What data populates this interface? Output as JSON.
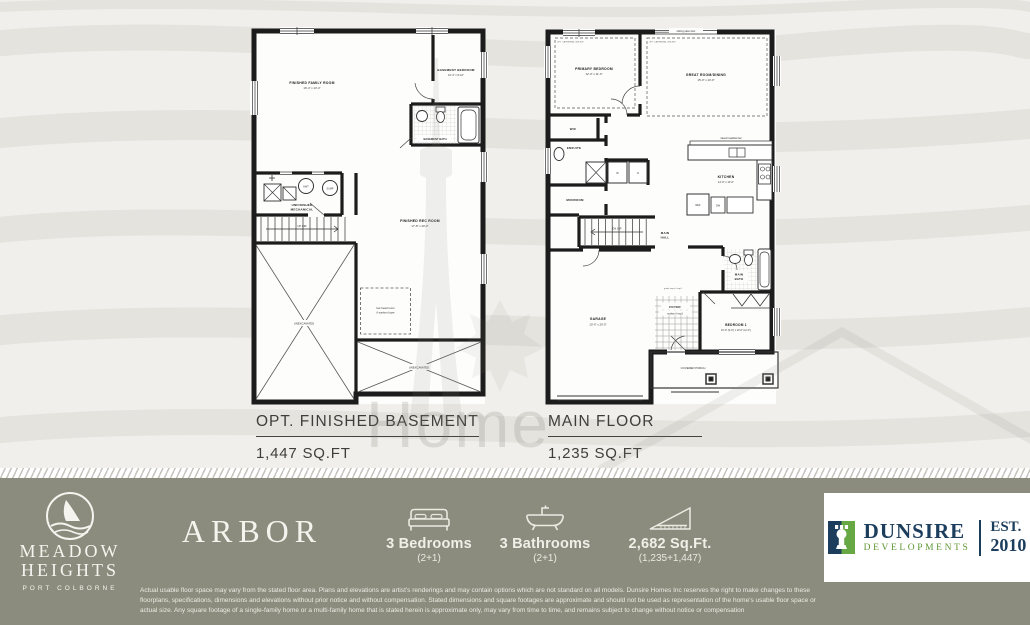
{
  "watermark": {
    "word1": "Home",
    "word2": "Leader",
    "word3": "Realty"
  },
  "basement": {
    "title": "OPT. FINISHED BASEMENT",
    "area": "1,447 SQ.FT",
    "family": {
      "name": "FINISHED FAMILY ROOM",
      "dims": "16'-4\" x 13'-4\""
    },
    "bedroom": {
      "name": "BASEMENT BEDROOM",
      "dims": "10'-4\" x 9'-10\""
    },
    "bath_label": "BASEMENT BATH",
    "mech": {
      "line1": "UNFINISHED",
      "line2": "MECHANICAL"
    },
    "hwt": "HWT",
    "sump": "SUMP",
    "rec": {
      "name": "FINISHED REC ROOM",
      "dims": "17'-8\" x 20'-0\""
    },
    "unexcavated": "UNEXCAVATED",
    "low_head": {
      "line1": "low head room",
      "line2": "if sunken foyer"
    },
    "stairs_label": "UP 14R"
  },
  "main_floor": {
    "title": "MAIN FLOOR",
    "area": "1,235 SQ.FT",
    "primary": {
      "name": "PRIMARY BEDROOM",
      "dims": "12'-0\" x 11'-0\""
    },
    "great": {
      "name": "GREAT ROOM/DINING",
      "dims": "15'-0\" x 13'-0\""
    },
    "patio_door": "sliding patio door",
    "cathedral": "OPT. CATHEDRAL CEILING",
    "wic": "WIC",
    "ensuite": "ENSUITE",
    "mudroom": "MUDROOM",
    "w": "W",
    "d": "D",
    "kitchen": {
      "name": "KITCHEN",
      "dims": "12'-0\" x 12'-0\""
    },
    "breakfast_bar": "raised breakfast bar",
    "ref": "REF",
    "dw": "DW",
    "hall": {
      "line1": "MAIN",
      "line2": "HALL"
    },
    "bath": {
      "line1": "MAIN",
      "line2": "BATH"
    },
    "garage": {
      "name": "GARAGE",
      "dims": "10'-0\" x 20'-0\""
    },
    "foyer": {
      "name": "FOYER",
      "sub": "sunken if req'd",
      "steps": "grade steps if req'd"
    },
    "bedroom1": {
      "name": "BEDROOM 1",
      "dims": "10'-0\" (9'-0\") x 10'-0\" (11'-4\")"
    },
    "porch": "COVERED PORCH",
    "stairs_label": "DN 14R"
  },
  "footer": {
    "logo": {
      "line1": "MEADOW",
      "line2": "HEIGHTS",
      "sub": "PORT COLBORNE"
    },
    "model_name": "ARBOR",
    "stats": [
      {
        "icon": "bed-icon",
        "label": "3 Bedrooms",
        "sub": "(2+1)"
      },
      {
        "icon": "bath-icon",
        "label": "3 Bathrooms",
        "sub": "(2+1)"
      },
      {
        "icon": "sqft-icon",
        "label": "2,682 Sq.Ft.",
        "sub": "(1,235+1,447)"
      }
    ],
    "disclaimer": "Actual usable floor space may vary from the stated floor area. Plans and elevations are artist's renderings and may contain options which are not standard on all models. Dunsire Homes Inc reserves the right to make changes to these floorplans, specifications, dimensions and elevations without prior notice and without compensation. Stated dimensions and square footages are approximate and should not be used as representation of the home's usable floor space or actual size. Any square footage of a single-family home or a multi-family home that is stated herein is approximate only, may vary from time to time, and remains subject to change without notice or compensation",
    "dunsire": {
      "name": "DUNSIRE",
      "division": "DEVELOPMENTS",
      "est": "EST.",
      "year": "2010"
    }
  },
  "colors": {
    "footer_bg": "#8b8c7d",
    "dunsire_navy": "#1c3e5c",
    "dunsire_green": "#5d9732",
    "page_bg": "#f1efeb"
  }
}
